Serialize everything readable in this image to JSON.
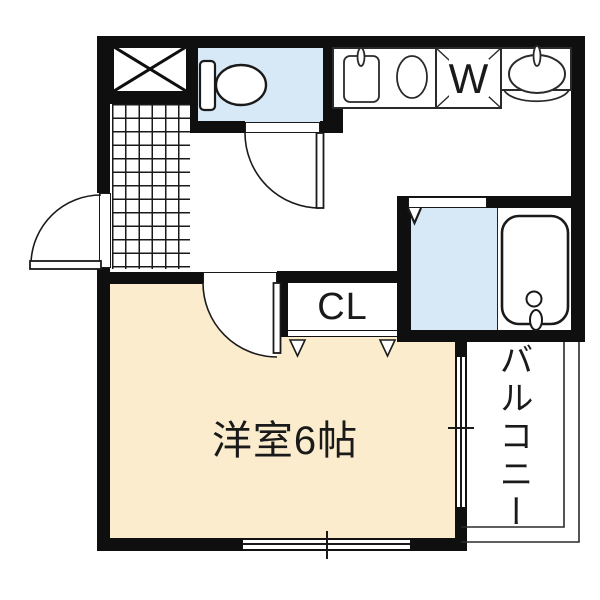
{
  "plan": {
    "type": "apartment-floor-plan",
    "labels": {
      "western_room": "洋室6帖",
      "closet": "CL",
      "washing_machine": "W",
      "balcony": "バルコニー"
    },
    "colors": {
      "wall": "#0f0f0f",
      "wet_area_floor": "#d7e8f6",
      "western_room_floor": "#faeccd",
      "background": "#ffffff"
    },
    "fixtures": [
      "toilet",
      "kitchen-sink",
      "burner",
      "washing-machine-space",
      "washbasin",
      "bathtub",
      "entrance-tile",
      "shaft"
    ]
  }
}
